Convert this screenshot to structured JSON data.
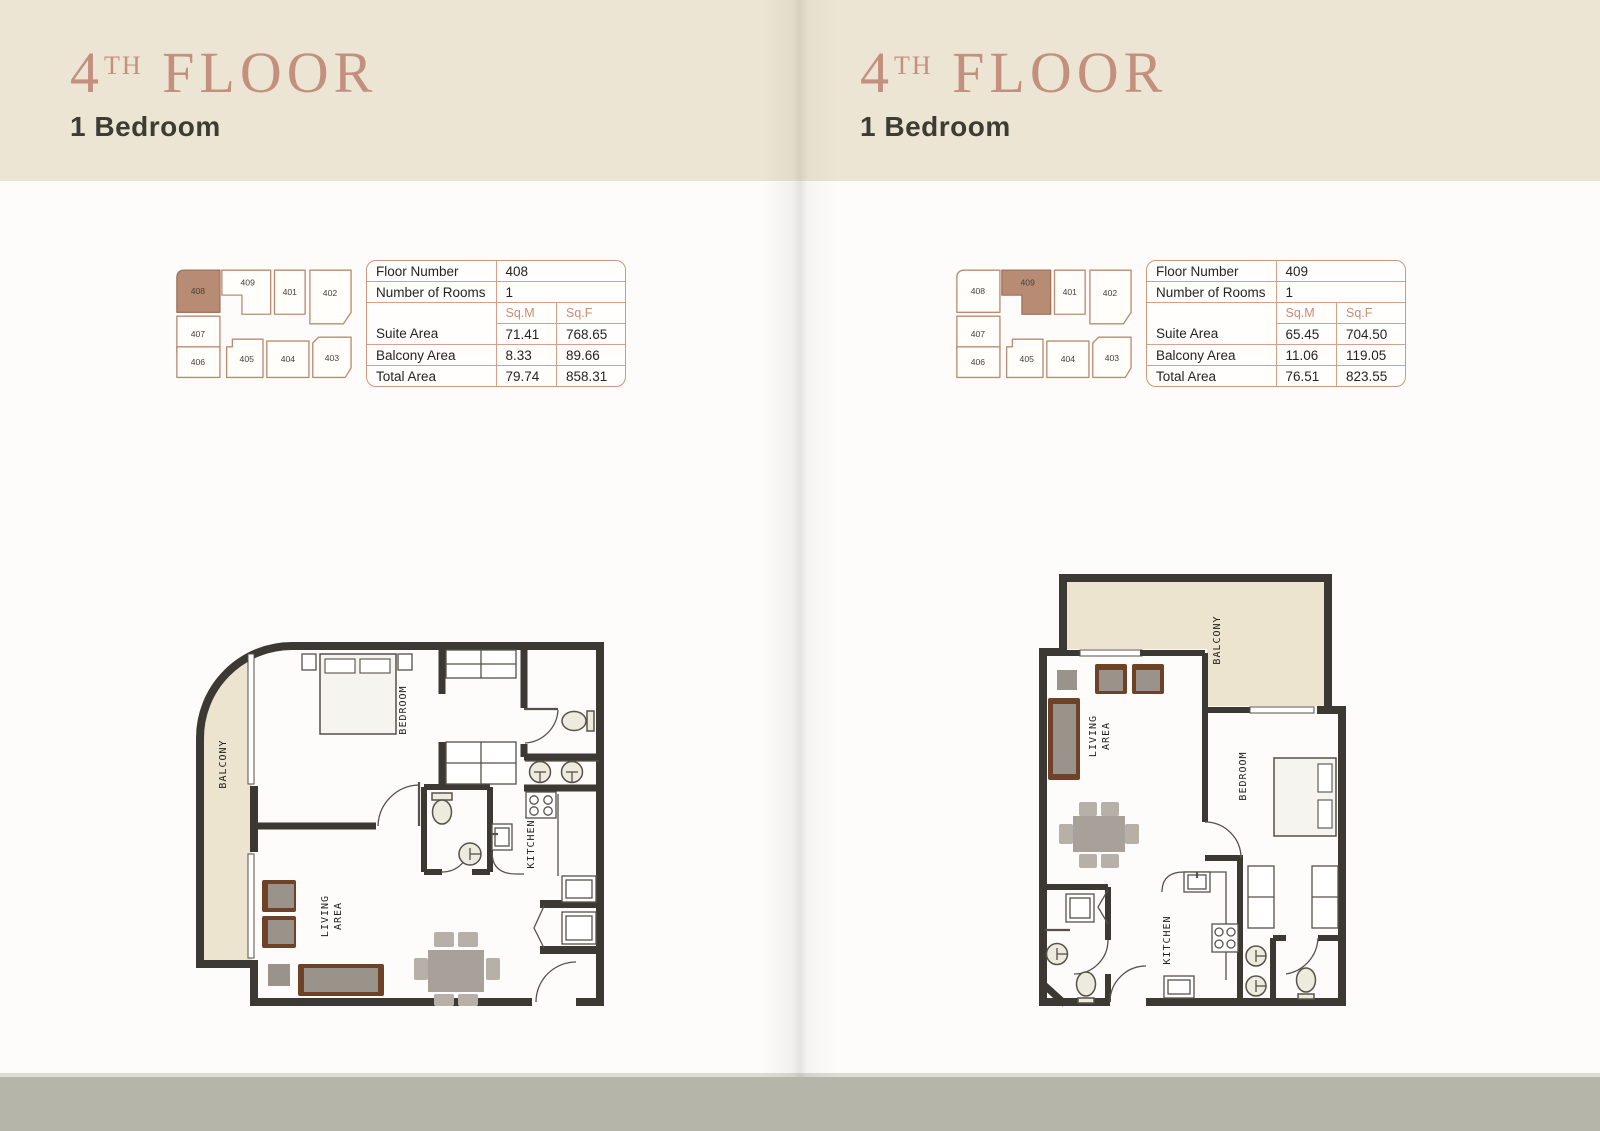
{
  "colors": {
    "header_band": "#ece5d3",
    "title_rose": "#c3907f",
    "subtitle_dark": "#3c3c35",
    "table_border": "#cb997f",
    "unit_header_rose": "#c68e74",
    "keyplan_outline": "#b98c73",
    "keyplan_highlight": "#b78b74",
    "wall_dark": "#3c3935",
    "balcony_fill": "#ece4cf",
    "bottom_band": "#b5b5aa"
  },
  "plan_labels": {
    "balcony": "BALCONY",
    "bedroom": "BEDROOM",
    "living_line1": "LIVING",
    "living_line2": "AREA",
    "kitchen": "KITCHEN"
  },
  "left": {
    "header": {
      "floor_digit": "4",
      "floor_ordinal": "TH",
      "floor_word": " FLOOR",
      "subtitle": "1 Bedroom"
    },
    "keyplan": {
      "highlighted": "408",
      "units": [
        "408",
        "409",
        "401",
        "402",
        "407",
        "406",
        "405",
        "404",
        "403"
      ]
    },
    "table": {
      "floor_number_label": "Floor Number",
      "floor_number": "408",
      "rooms_label": "Number of Rooms",
      "rooms": "1",
      "sqm": "Sq.M",
      "sqf": "Sq.F",
      "rows": [
        {
          "label": "Suite Area",
          "sqm": "71.41",
          "sqf": "768.65"
        },
        {
          "label": "Balcony Area",
          "sqm": "8.33",
          "sqf": "89.66"
        },
        {
          "label": "Total Area",
          "sqm": "79.74",
          "sqf": "858.31"
        }
      ]
    }
  },
  "right": {
    "header": {
      "floor_digit": "4",
      "floor_ordinal": "TH",
      "floor_word": " FLOOR",
      "subtitle": "1 Bedroom"
    },
    "keyplan": {
      "highlighted": "409",
      "units": [
        "408",
        "409",
        "401",
        "402",
        "407",
        "406",
        "405",
        "404",
        "403"
      ]
    },
    "table": {
      "floor_number_label": "Floor Number",
      "floor_number": "409",
      "rooms_label": "Number of Rooms",
      "rooms": "1",
      "sqm": "Sq.M",
      "sqf": "Sq.F",
      "rows": [
        {
          "label": "Suite Area",
          "sqm": "65.45",
          "sqf": "704.50"
        },
        {
          "label": "Balcony Area",
          "sqm": "11.06",
          "sqf": "119.05"
        },
        {
          "label": "Total Area",
          "sqm": "76.51",
          "sqf": "823.55"
        }
      ]
    }
  }
}
